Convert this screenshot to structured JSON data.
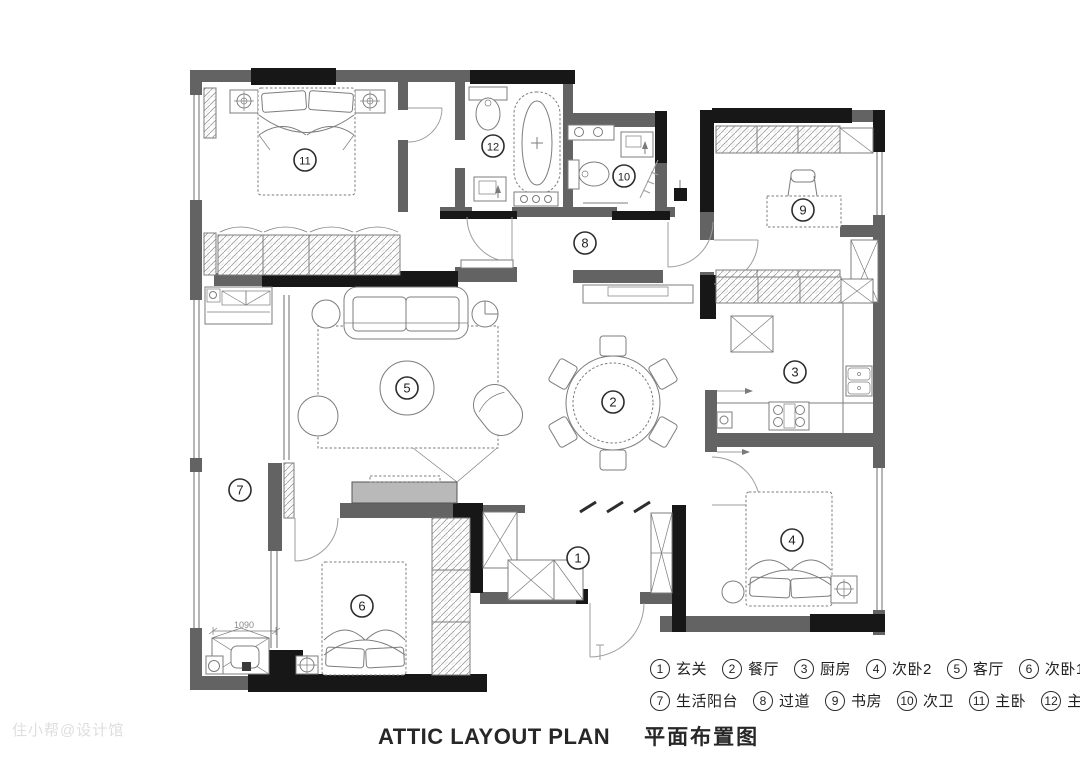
{
  "page": {
    "title_en": "ATTIC LAYOUT PLAN",
    "title_zh": "平面布置图",
    "watermark": "住小帮@设计馆"
  },
  "legend": {
    "rows": [
      [
        {
          "num": "1",
          "label": "玄关"
        },
        {
          "num": "2",
          "label": "餐厅"
        },
        {
          "num": "3",
          "label": "厨房"
        },
        {
          "num": "4",
          "label": "次卧2"
        },
        {
          "num": "5",
          "label": "客厅"
        },
        {
          "num": "6",
          "label": "次卧1"
        }
      ],
      [
        {
          "num": "7",
          "label": "生活阳台"
        },
        {
          "num": "8",
          "label": "过道"
        },
        {
          "num": "9",
          "label": "书房"
        },
        {
          "num": "10",
          "label": "次卫"
        },
        {
          "num": "11",
          "label": "主卧"
        },
        {
          "num": "12",
          "label": "主卫"
        }
      ]
    ]
  },
  "rooms": [
    {
      "num": "1",
      "name": "玄关",
      "x": 578,
      "y": 558
    },
    {
      "num": "2",
      "name": "餐厅",
      "x": 613,
      "y": 402
    },
    {
      "num": "3",
      "name": "厨房",
      "x": 795,
      "y": 372
    },
    {
      "num": "4",
      "name": "次卧2",
      "x": 792,
      "y": 540
    },
    {
      "num": "5",
      "name": "客厅",
      "x": 407,
      "y": 388
    },
    {
      "num": "6",
      "name": "次卧1",
      "x": 362,
      "y": 606
    },
    {
      "num": "7",
      "name": "生活阳台",
      "x": 240,
      "y": 490
    },
    {
      "num": "8",
      "name": "过道",
      "x": 585,
      "y": 243
    },
    {
      "num": "9",
      "name": "书房",
      "x": 803,
      "y": 210
    },
    {
      "num": "10",
      "name": "次卫",
      "x": 624,
      "y": 176
    },
    {
      "num": "11",
      "name": "主卧",
      "x": 305,
      "y": 160
    },
    {
      "num": "12",
      "name": "主卫",
      "x": 493,
      "y": 146
    }
  ],
  "dimensions": [
    {
      "text": "1090",
      "x": 244,
      "y": 628
    }
  ],
  "colors": {
    "wall_gray": "#636363",
    "wall_black": "#171717",
    "line": "#7d7d7d",
    "text": "#1f1f1f",
    "watermark": "#dedede"
  }
}
